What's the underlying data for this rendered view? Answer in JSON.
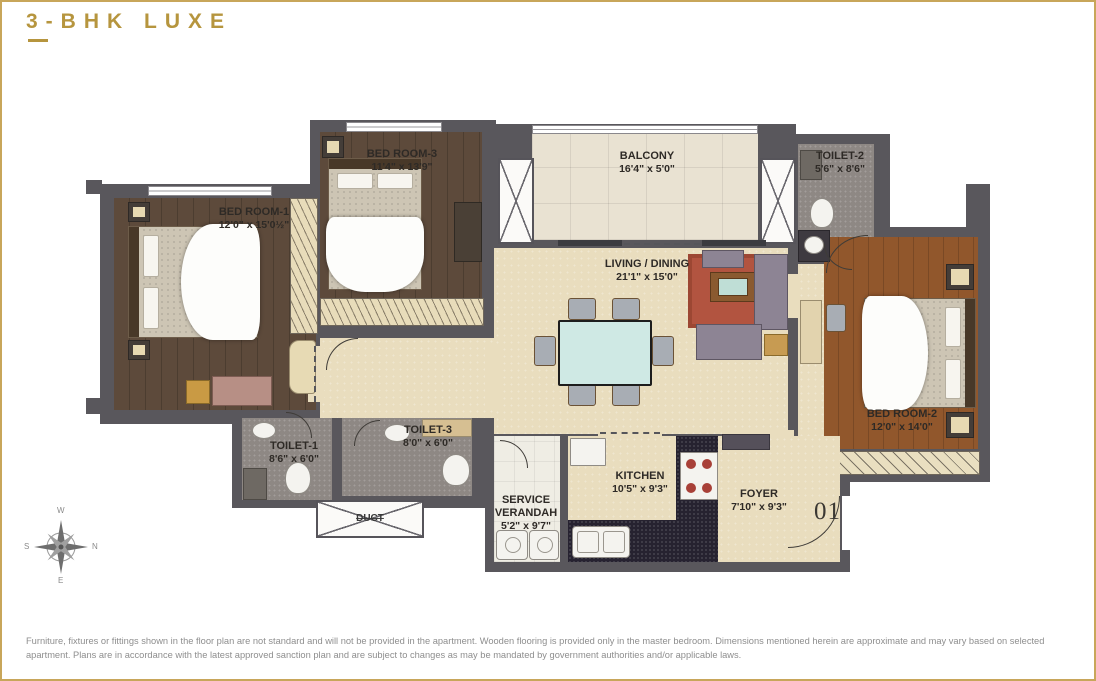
{
  "page": {
    "title": "3-BHK LUXE"
  },
  "plan": {
    "rooms": {
      "bedroom1": {
        "name": "BED ROOM-1",
        "dims": "12'0\" x 15'0½\""
      },
      "bedroom3": {
        "name": "BED ROOM-3",
        "dims": "11'4\" x 13'9\""
      },
      "bedroom2": {
        "name": "BED ROOM-2",
        "dims": "12'0\" x 14'0\""
      },
      "balcony": {
        "name": "BALCONY",
        "dims": "16'4\" x 5'0\""
      },
      "living": {
        "name": "LIVING / DINING",
        "dims": "21'1\" x 15'0\""
      },
      "toilet1": {
        "name": "TOILET-1",
        "dims": "8'6\" x 6'0\""
      },
      "toilet2": {
        "name": "TOILET-2",
        "dims": "5'6\" x 8'6\""
      },
      "toilet3": {
        "name": "TOILET-3",
        "dims": "8'0\" x 6'0\""
      },
      "kitchen": {
        "name": "KITCHEN",
        "dims": "10'5\" x 9'3\""
      },
      "service_verandah": {
        "name": "SERVICE VERANDAH",
        "dims": "5'2\" x 9'7\""
      },
      "foyer": {
        "name": "FOYER",
        "dims": "7'10\" x 9'3\""
      },
      "duct": {
        "name": "DUCT"
      }
    },
    "unit_number": "01"
  },
  "compass": {
    "top": "W",
    "right": "N",
    "bottom": "E",
    "left": "S"
  },
  "colors": {
    "accent_gold": "#b6953e",
    "wall": "#59575c",
    "wood_master": "#5d4a3b",
    "wood_bedroom2": "#91572c",
    "floor_cream": "#e9ddbe"
  },
  "footer": {
    "disclaimer": "Furniture, fixtures or fittings shown in the floor plan are not standard and will not be provided in the apartment. Wooden flooring is provided only in the master bedroom. Dimensions mentioned herein are approximate and may vary based on selected apartment. Plans are in accordance with the latest approved sanction plan and are subject to changes as may be mandated by government authorities and/or applicable laws."
  }
}
